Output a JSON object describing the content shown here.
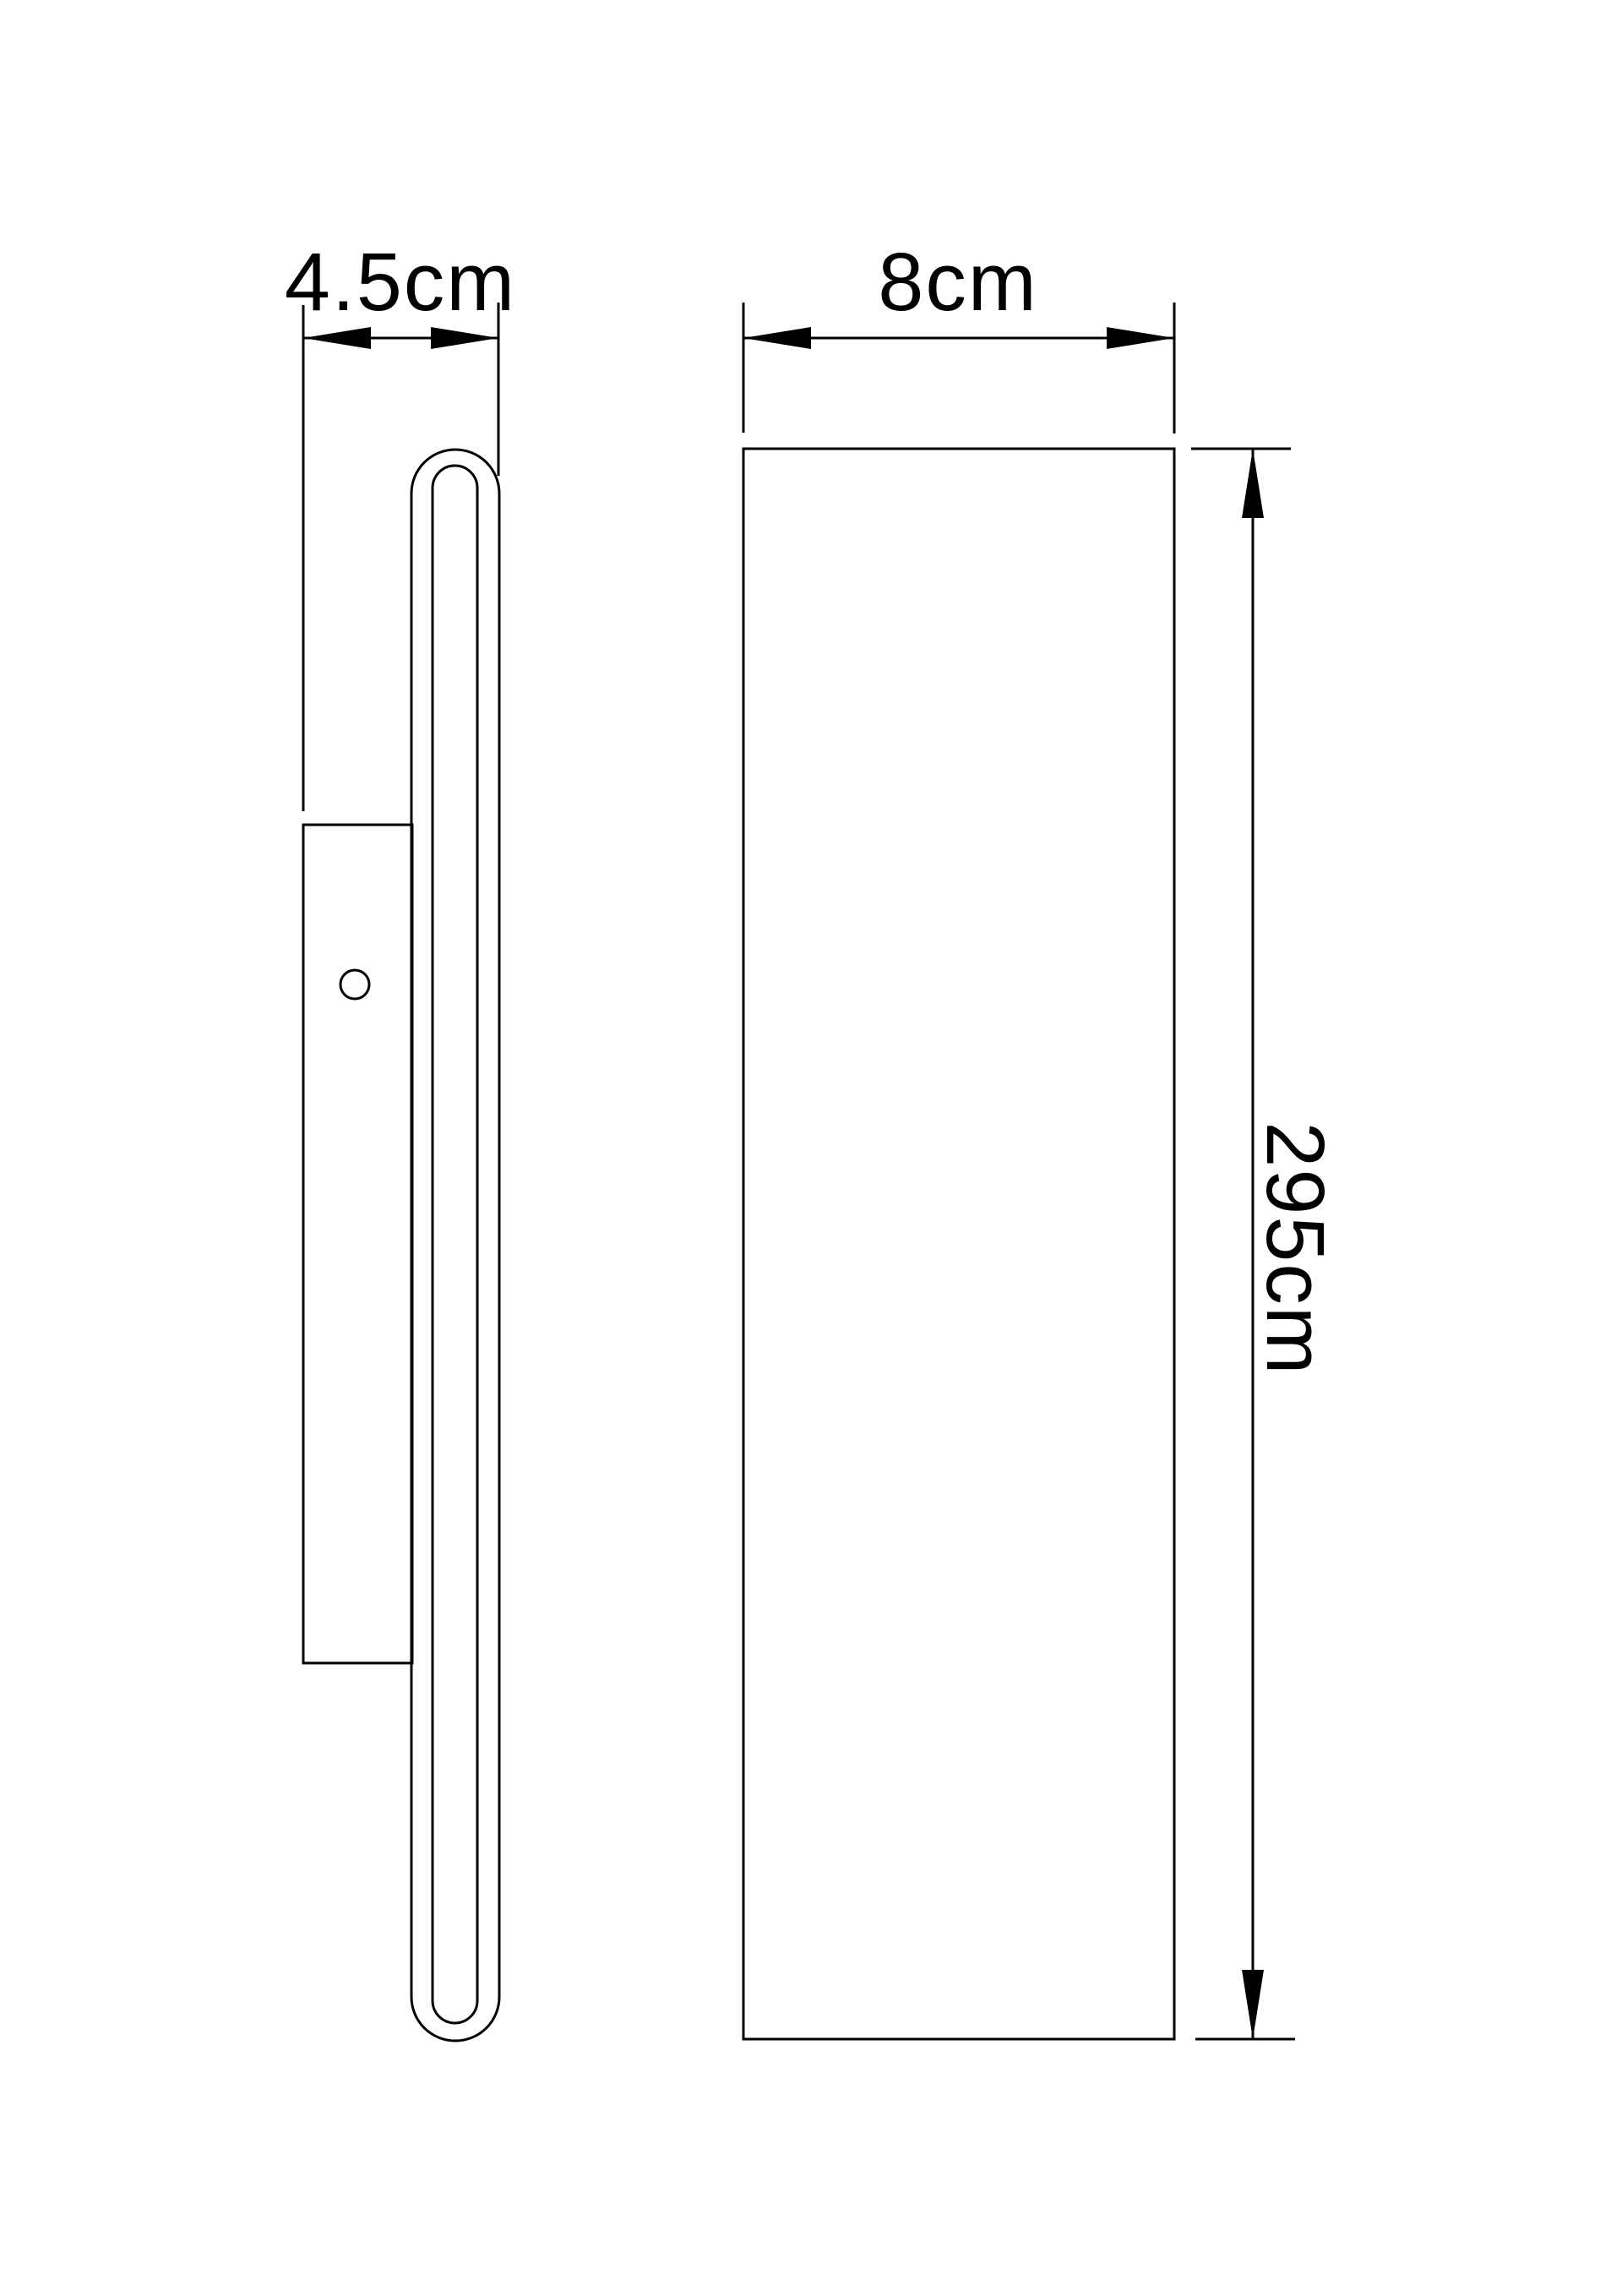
{
  "drawing": {
    "type": "technical-dimension-drawing",
    "subject": "wall-mounted linear lamp",
    "background_color": "#ffffff",
    "line_color": "#000000",
    "views": {
      "side_view": {
        "name": "side profile view",
        "parts": [
          "wall-bracket-plate",
          "mounting-hole",
          "lamp-body-profile-outer",
          "lamp-body-profile-inner"
        ]
      },
      "front_view": {
        "name": "front view",
        "parts": [
          "lamp-body-front-panel"
        ]
      }
    },
    "dimensions": {
      "depth": {
        "label": "4.5cm",
        "value": 4.5,
        "unit": "cm",
        "orientation": "horizontal",
        "applies_to": "side view overall depth"
      },
      "width": {
        "label": "8cm",
        "value": 8,
        "unit": "cm",
        "orientation": "horizontal",
        "applies_to": "front view overall width"
      },
      "height": {
        "label": "295cm",
        "value": 295,
        "unit": "cm",
        "orientation": "vertical",
        "applies_to": "front view overall height"
      }
    }
  }
}
